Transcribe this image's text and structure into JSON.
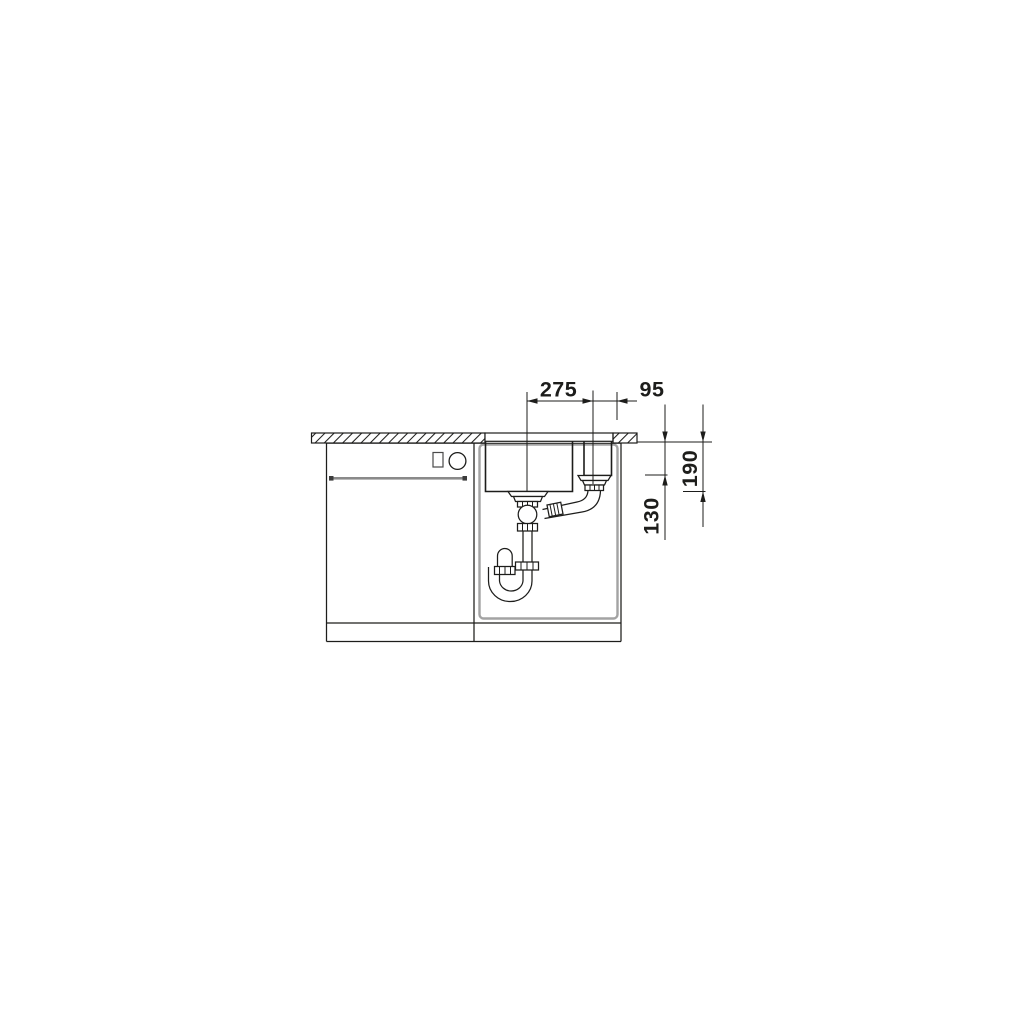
{
  "drawing": {
    "type": "technical-installation-section",
    "subject": "undermount double-bowl kitchen sink in base cabinet with drain trap, beside appliance cabinet",
    "background_color": "#ffffff",
    "line_color": "#1d1d1b",
    "carcass_line_color": "#a3a3a3",
    "dimension_labels": {
      "bowl_center_spacing_mm": "275",
      "drain_to_right_edge_mm": "95",
      "main_bowl_depth_mm": "190",
      "small_bowl_depth_mm": "130"
    }
  }
}
